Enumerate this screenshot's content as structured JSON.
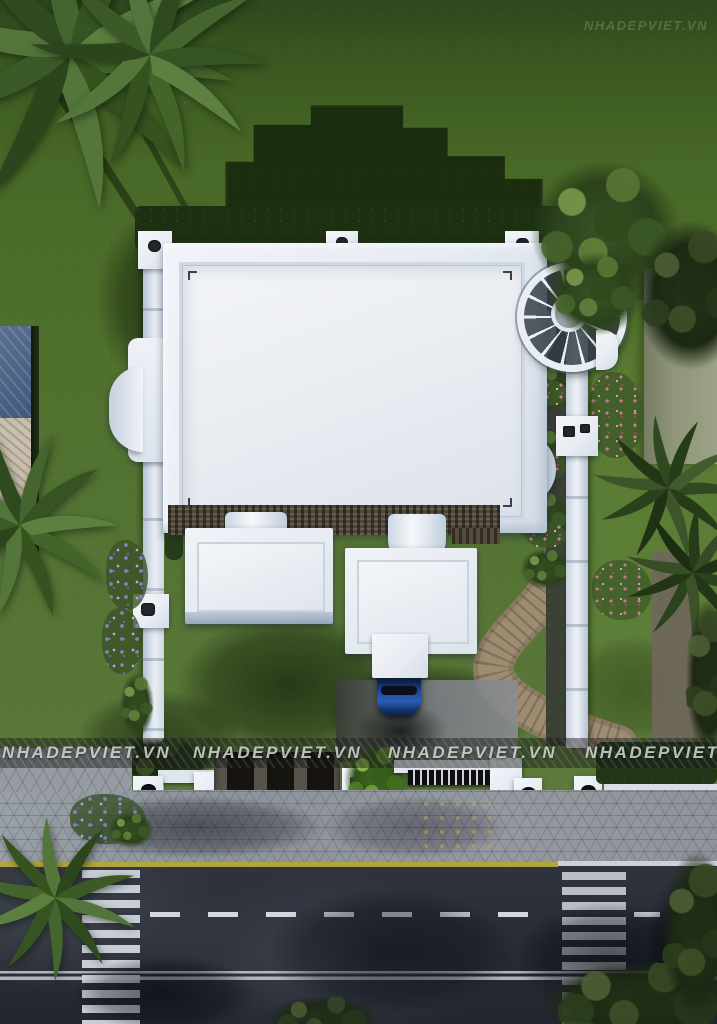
{
  "watermark": {
    "text": "NHADEPVIET.VN"
  },
  "palette": {
    "lawn_green": "#4f6f2c",
    "lawn_shadow": "#16280c",
    "roof_white": "#eef1f6",
    "roof_inner": "#e8ebf1",
    "roof_shade_blue": "#bfcddc",
    "shingle_dark": "#4d4538",
    "foliage_dark": "#2c421c",
    "foliage_light": "#6b8c49",
    "path_tan": "#98876d",
    "gravel_gray": "#6e675a",
    "car_blue": "#1c4fa0",
    "flower_purple": "#8b7fc4",
    "flower_pink": "#cf7d96",
    "sidewalk_gray": "#949aa2",
    "road_asphalt": "#2a2e37",
    "road_marking_white": "#d3d8de",
    "road_edge_yellow": "#b3a53e",
    "neighbor_roof_blue": "#4c638a",
    "neighbor_roof_beige": "#c9bfae",
    "boundary_wall_white": "#dfe5ec"
  }
}
